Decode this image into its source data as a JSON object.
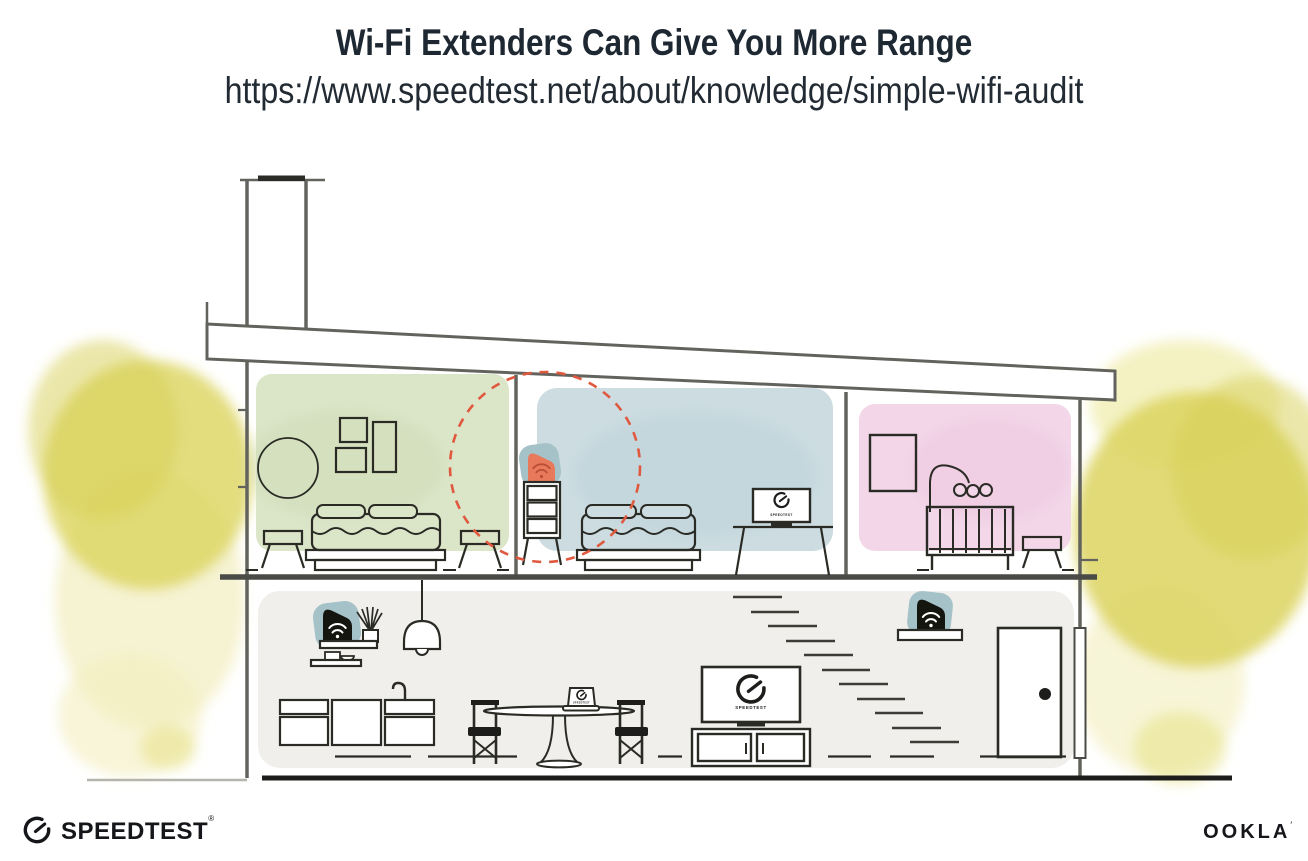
{
  "header": {
    "title": "Wi-Fi Extenders Can Give You More Range",
    "url": "https://www.speedtest.net/about/knowledge/simple-wifi-audit"
  },
  "devices": {
    "screen_label": "SPEEDTEST"
  },
  "footer": {
    "speedtest_wordmark": "SPEEDTEST",
    "speedtest_reg_mark": "®",
    "ookla_wordmark": "OOKLA",
    "ookla_tm_mark": "′"
  },
  "colors": {
    "ink": "#1e2832",
    "line_dark": "#23231f",
    "wall_gray": "#63635e",
    "room_green": "#dbe5c8",
    "room_blue": "#ccdce1",
    "room_pink": "#f3d7e9",
    "floor_gray": "#f0efec",
    "foliage_yellow": "#dcd45f",
    "foliage_light": "#efe9ad",
    "device_teal": "#a5c2c8",
    "extender_orange": "#e8795b",
    "extender_icon_orange": "#b84e36",
    "signal_red": "#e0593f"
  }
}
